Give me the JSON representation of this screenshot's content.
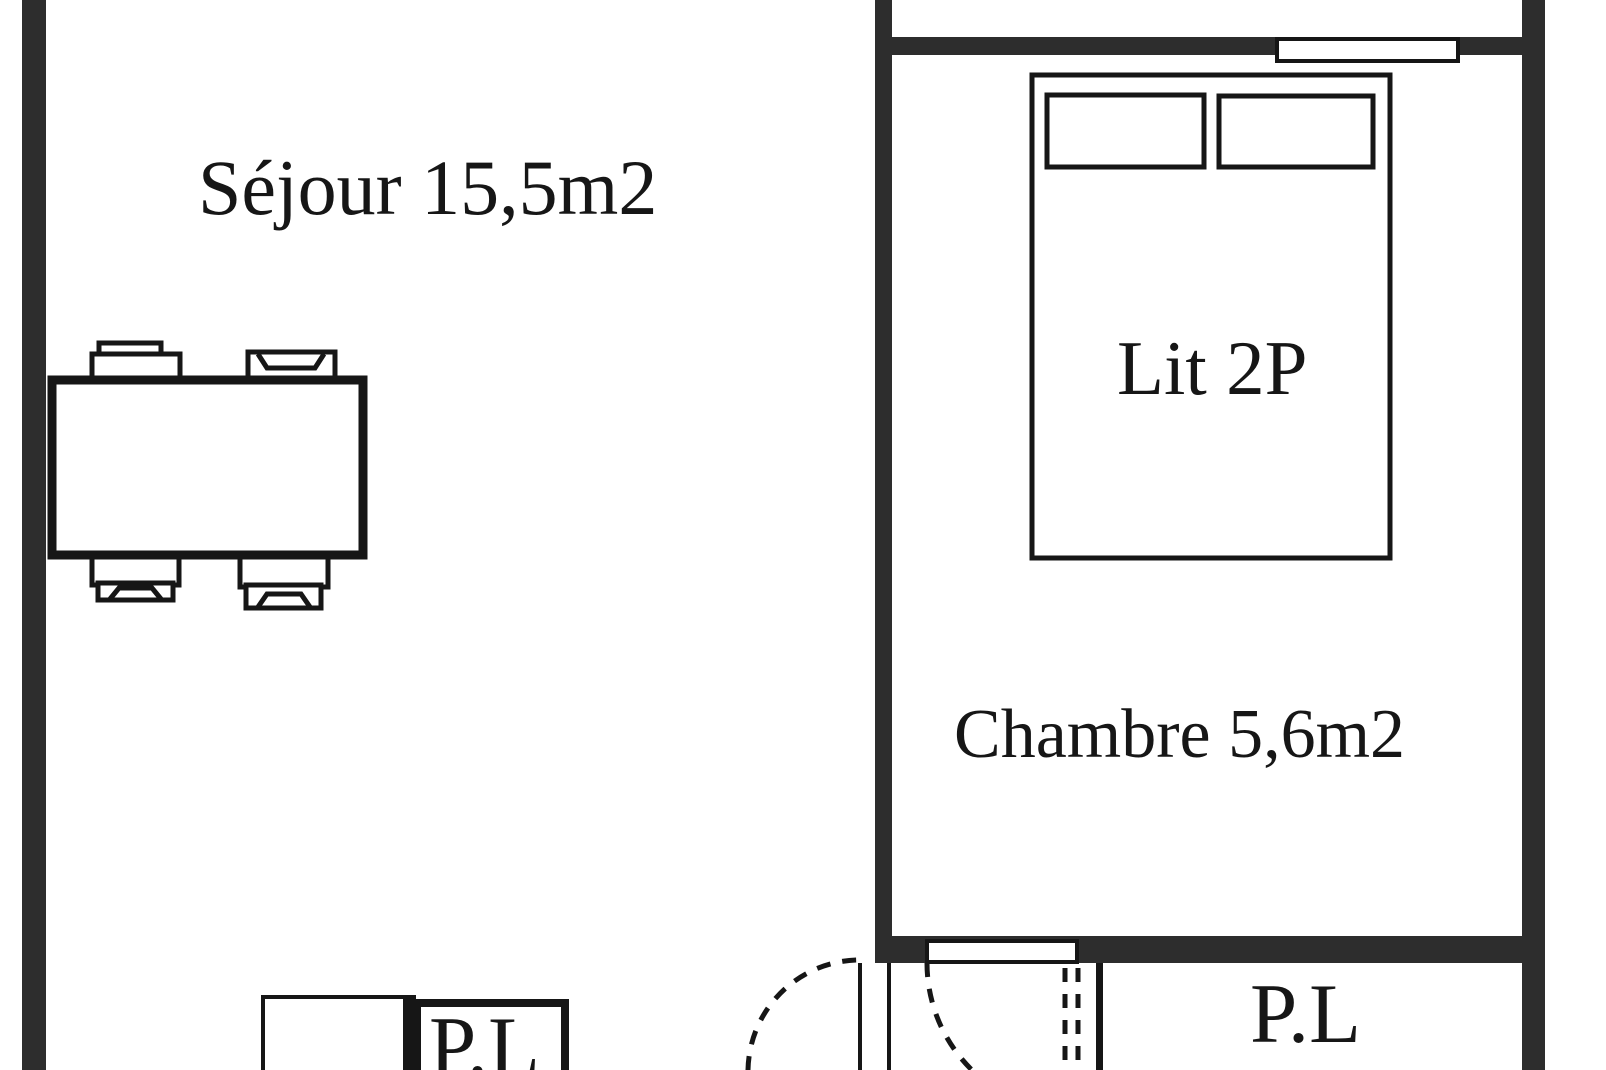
{
  "plan": {
    "rooms": [
      {
        "id": "sejour",
        "label": "Séjour 15,5m2",
        "area": "15,5"
      },
      {
        "id": "chambre",
        "label": "Chambre 5,6m2",
        "area": "5,6"
      }
    ],
    "furniture": {
      "bed_label": "Lit 2P"
    },
    "closets": {
      "left_label": "P.L",
      "right_label": "P.L"
    }
  },
  "colors": {
    "wall": "#2d2d2d",
    "line": "#161616",
    "bg": "#ffffff",
    "text": "#161616"
  }
}
